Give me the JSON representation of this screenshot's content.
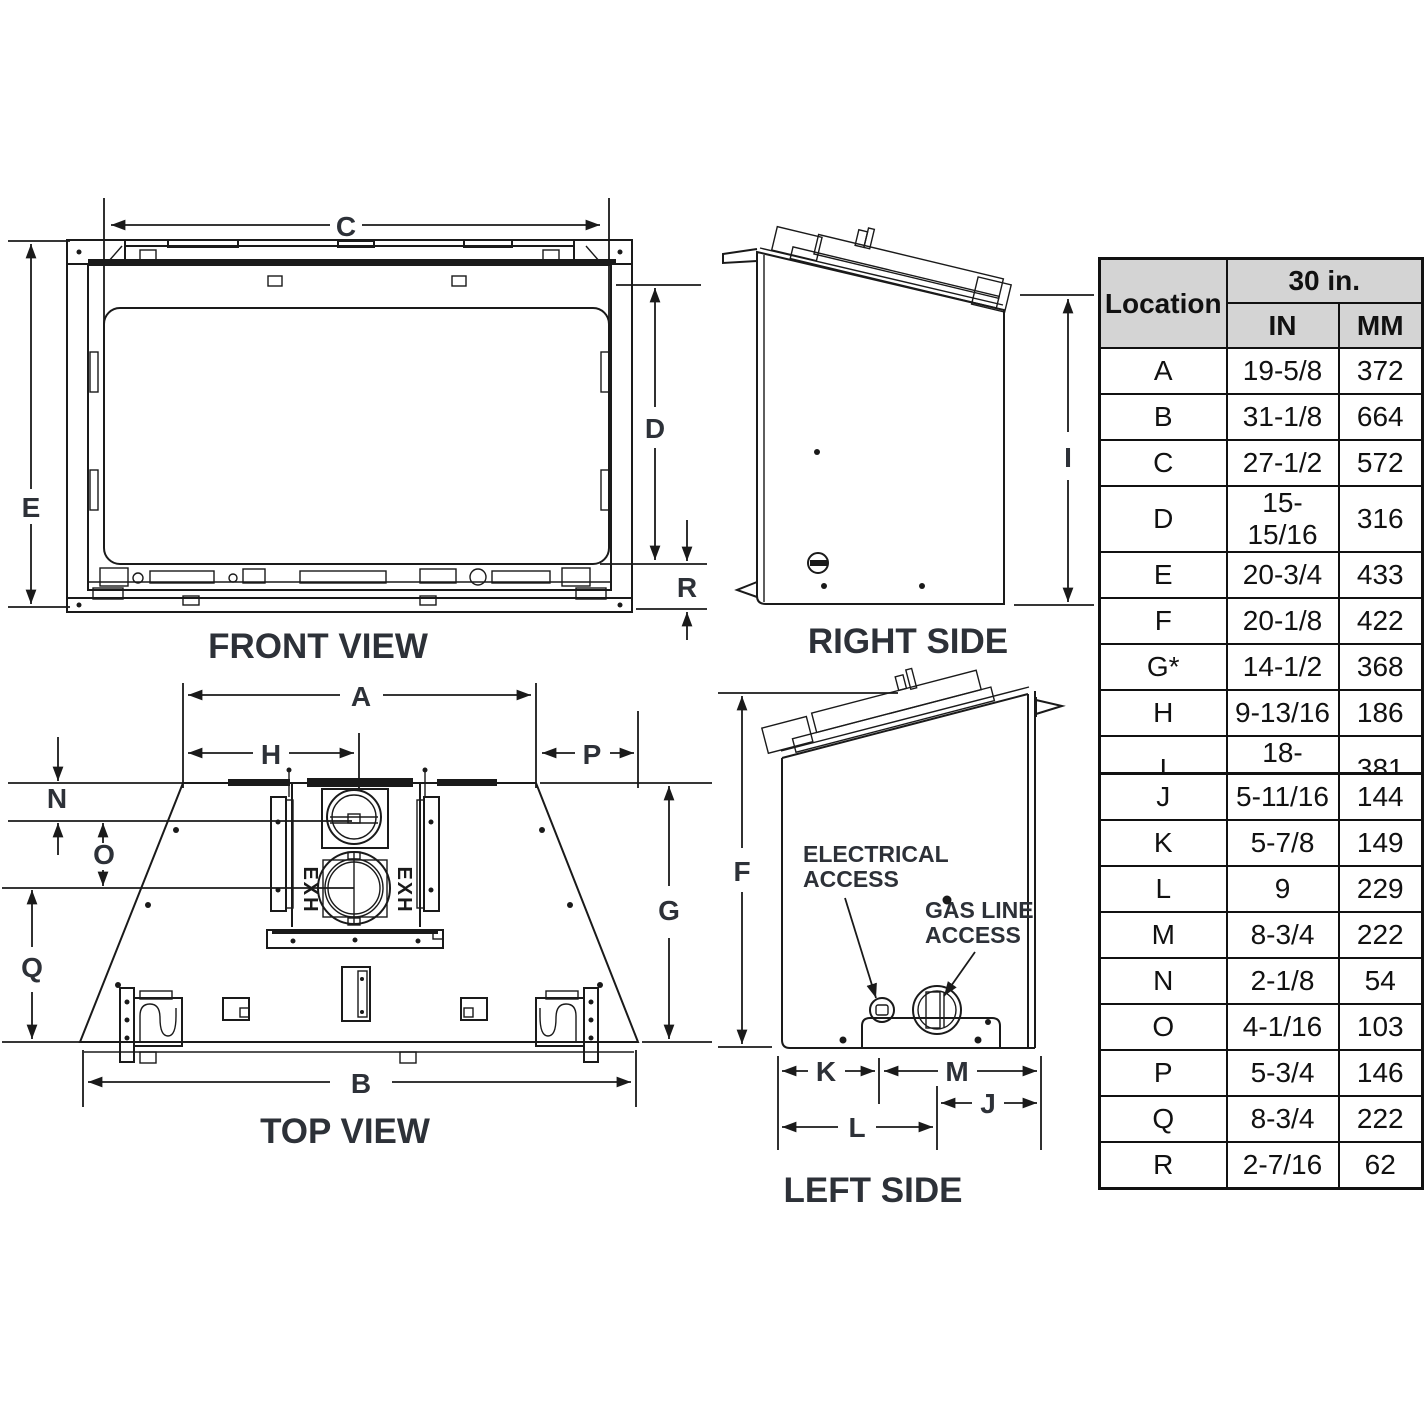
{
  "front_view": {
    "title": "FRONT VIEW",
    "c": "C",
    "e": "E",
    "d": "D",
    "r": "R"
  },
  "right_side": {
    "title": "RIGHT SIDE",
    "i": "I"
  },
  "top_view": {
    "title": "TOP VIEW",
    "a": "A",
    "h": "H",
    "p": "P",
    "n": "N",
    "o": "O",
    "q": "Q",
    "g": "G",
    "b": "B",
    "exh": "EXH"
  },
  "left_side": {
    "title": "LEFT SIDE",
    "f": "F",
    "k": "K",
    "m": "M",
    "j": "J",
    "l": "L",
    "electrical_access": {
      "line1": "ELECTRICAL",
      "line2": "ACCESS"
    },
    "gas_line_access": {
      "line1": "GAS LINE",
      "line2": "ACCESS"
    }
  },
  "spec_table": {
    "header": {
      "location": "Location",
      "size": "30 in.",
      "in": "IN",
      "mm": "MM"
    },
    "rows": [
      {
        "loc": "A",
        "in": "19-5/8",
        "mm": "372"
      },
      {
        "loc": "B",
        "in": "31-1/8",
        "mm": "664"
      },
      {
        "loc": "C",
        "in": "27-1/2",
        "mm": "572"
      },
      {
        "loc": "D",
        "in": "15-15/16",
        "mm": "316"
      },
      {
        "loc": "E",
        "in": "20-3/4",
        "mm": "433"
      },
      {
        "loc": "F",
        "in": "20-1/8",
        "mm": "422"
      },
      {
        "loc": "G*",
        "in": "14-1/2",
        "mm": "368"
      },
      {
        "loc": "H",
        "in": "9-13/16",
        "mm": "186"
      },
      {
        "loc": "I",
        "in": "18-15/16",
        "mm": "381"
      },
      {
        "loc": "J",
        "in": "5-11/16",
        "mm": "144"
      },
      {
        "loc": "K",
        "in": "5-7/8",
        "mm": "149"
      },
      {
        "loc": "L",
        "in": "9",
        "mm": "229"
      },
      {
        "loc": "M",
        "in": "8-3/4",
        "mm": "222"
      },
      {
        "loc": "N",
        "in": "2-1/8",
        "mm": "54"
      },
      {
        "loc": "O",
        "in": "4-1/16",
        "mm": "103"
      },
      {
        "loc": "P",
        "in": "5-3/4",
        "mm": "146"
      },
      {
        "loc": "Q",
        "in": "8-3/4",
        "mm": "222"
      },
      {
        "loc": "R",
        "in": "2-7/16",
        "mm": "62"
      }
    ]
  },
  "colors": {
    "line": "#1a1a1a",
    "text": "#2d3138",
    "table_header_bg": "#d4d4d4"
  }
}
